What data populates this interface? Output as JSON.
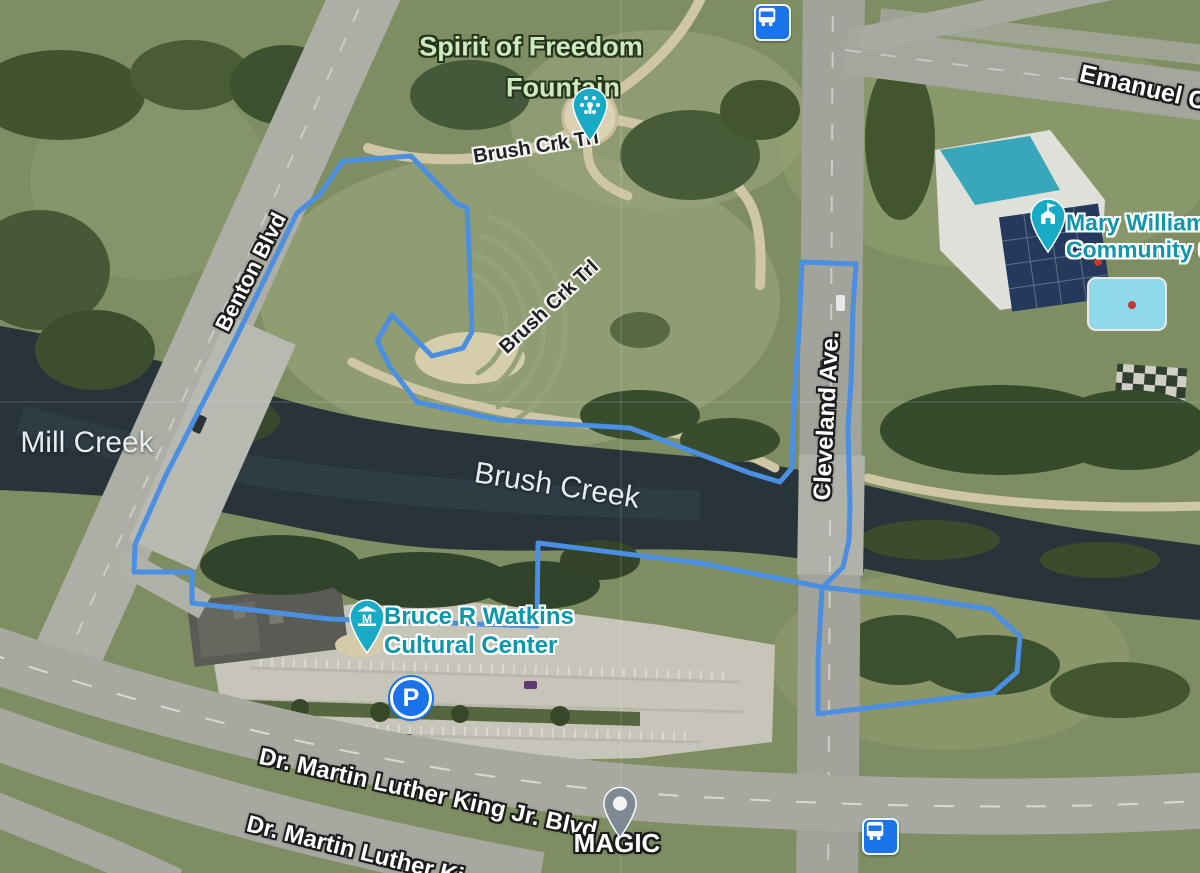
{
  "map": {
    "view": "satellite",
    "labels": {
      "spirit_line1": "Spirit of Freedom",
      "spirit_line2": "Fountain",
      "brush_crk_trl_upper": "Brush Crk Trl",
      "brush_crk_trl_lower": "Brush Crk Trl",
      "benton_blvd": "Benton Blvd",
      "mill_creek": "Mill Creek",
      "brush_creek": "Brush Creek",
      "cleveland_ave": "Cleveland Ave.",
      "mary_williams_line1": "Mary Williams",
      "mary_williams_line2": "Community C",
      "emanuel": "Emanuel C",
      "watkins_line1": "Bruce R Watkins",
      "watkins_line2": "Cultural Center",
      "mlk_blvd_full": "Dr. Martin Luther King Jr. Blvd",
      "mlk_blvd_clipped": "Dr. Martin Luther Ki",
      "magic": "MAGIC",
      "parking_letter": "P",
      "museum_letter": "M"
    },
    "colors": {
      "route_blue": "#4a8fe2",
      "poi_pin_teal": "#19aac6",
      "poi_text_teal": "#0f96ab",
      "park_label_green": "#cfeabf",
      "transit_blue": "#1a73e8",
      "generic_pin_gray": "#7d8a93",
      "water_label": "#e6edf0"
    },
    "route": {
      "color": "#4a8fe2",
      "points": [
        [
          135,
          545
        ],
        [
          134,
          572
        ],
        [
          192,
          572
        ],
        [
          192,
          603
        ],
        [
          330,
          619
        ],
        [
          537,
          626
        ],
        [
          538,
          543
        ],
        [
          700,
          563
        ],
        [
          822,
          587
        ],
        [
          916,
          598
        ],
        [
          990,
          609
        ],
        [
          1020,
          636
        ],
        [
          1017,
          672
        ],
        [
          993,
          693
        ],
        [
          833,
          712
        ],
        [
          818,
          714
        ],
        [
          818,
          660
        ],
        [
          822,
          588
        ],
        [
          843,
          567
        ],
        [
          849,
          540
        ],
        [
          850,
          507
        ],
        [
          848,
          427
        ],
        [
          851,
          383
        ],
        [
          853,
          307
        ],
        [
          856,
          264
        ],
        [
          802,
          262
        ],
        [
          799,
          330
        ],
        [
          795,
          387
        ],
        [
          793,
          432
        ],
        [
          792,
          468
        ],
        [
          780,
          482
        ],
        [
          750,
          473
        ],
        [
          630,
          428
        ],
        [
          500,
          420
        ],
        [
          417,
          402
        ],
        [
          390,
          367
        ],
        [
          377,
          341
        ],
        [
          392,
          315
        ],
        [
          432,
          356
        ],
        [
          463,
          348
        ],
        [
          472,
          332
        ],
        [
          469,
          250
        ],
        [
          467,
          208
        ],
        [
          456,
          203
        ],
        [
          411,
          156
        ],
        [
          343,
          161
        ],
        [
          320,
          194
        ],
        [
          297,
          213
        ],
        [
          230,
          350
        ],
        [
          165,
          477
        ],
        [
          137,
          540
        ],
        [
          135,
          545
        ]
      ]
    }
  }
}
